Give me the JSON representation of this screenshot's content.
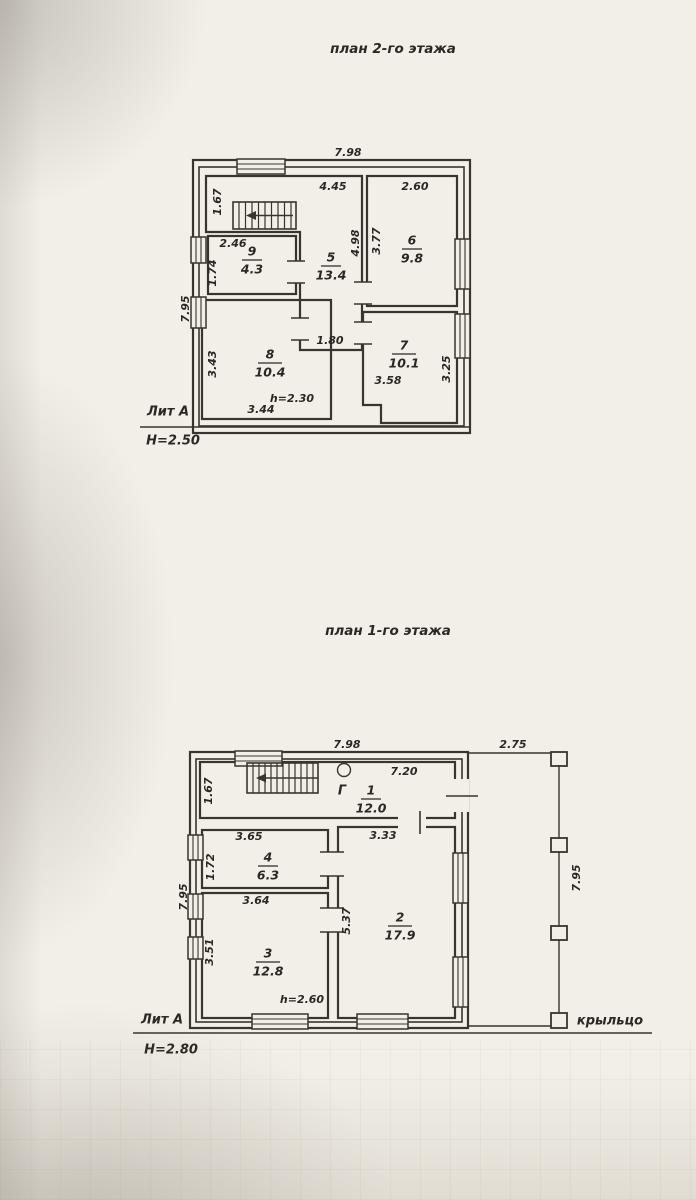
{
  "colors": {
    "ink": "#39342d",
    "text": "#2c2722",
    "paper": "#f2efe8"
  },
  "titles": {
    "floor2": "план 2-го этажа",
    "floor1": "план 1-го этажа"
  },
  "floor2": {
    "litera": "Лит А",
    "height_label": "Н=2.50",
    "dims": {
      "width_top": "7.98",
      "left_side": "7.95",
      "hall_top": "4.45",
      "room6_top": "2.60",
      "stair_left": "1.67",
      "room9_top": "2.46",
      "room9_left": "1.74",
      "room5_side": "4.98",
      "room6_side": "3.77",
      "corridor": "1.80",
      "room8_left": "3.43",
      "room8_bottom": "3.44",
      "room7_width": "3.58",
      "room7_right": "3.25",
      "ceiling": "h=2.30"
    },
    "rooms": {
      "r5": {
        "num": "5",
        "area": "13.4"
      },
      "r6": {
        "num": "6",
        "area": "9.8"
      },
      "r7": {
        "num": "7",
        "area": "10.1"
      },
      "r8": {
        "num": "8",
        "area": "10.4"
      },
      "r9": {
        "num": "9",
        "area": "4.3"
      }
    }
  },
  "floor1": {
    "litera": "Лит А",
    "height_label": "Н=2.80",
    "porch_label": "крыльцо",
    "gas_label": "Г",
    "dims": {
      "width_top": "7.98",
      "porch_top": "2.75",
      "left_side": "7.95",
      "porch_right": "7.95",
      "room1_top": "7.20",
      "stair_left": "1.67",
      "room4_top": "3.65",
      "room4_left": "1.72",
      "room2_top": "3.33",
      "room3_top": "3.64",
      "room3_left": "3.51",
      "room2_side": "5.37",
      "ceiling": "h=2.60"
    },
    "rooms": {
      "r1": {
        "num": "1",
        "area": "12.0"
      },
      "r2": {
        "num": "2",
        "area": "17.9"
      },
      "r3": {
        "num": "3",
        "area": "12.8"
      },
      "r4": {
        "num": "4",
        "area": "6.3"
      }
    }
  }
}
